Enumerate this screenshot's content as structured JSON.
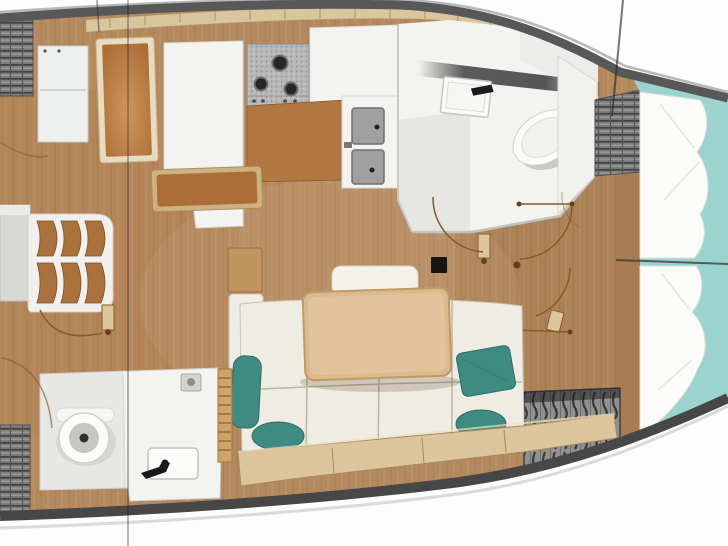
{
  "diagram": {
    "type": "yacht-interior-floorplan",
    "orientation": "bow-right",
    "regions": [
      {
        "name": "aft-lockers",
        "style": "hatched"
      },
      {
        "name": "companionway-steps",
        "steps": 3
      },
      {
        "name": "chart-table"
      },
      {
        "name": "galley",
        "fixtures": [
          "fridge",
          "stove-3-burner",
          "double-sink",
          "counter",
          "bench"
        ]
      },
      {
        "name": "forward-head",
        "fixtures": [
          "wash-basin",
          "faucet",
          "toilet",
          "door"
        ]
      },
      {
        "name": "aft-head",
        "fixtures": [
          "toilet",
          "wash-basin",
          "faucet",
          "shower-drain",
          "door"
        ]
      },
      {
        "name": "salon",
        "fixtures": [
          "l-settee",
          "dining-table",
          "headrest",
          "teal-pillows",
          "mast-post"
        ]
      },
      {
        "name": "forward-cabin",
        "fixtures": [
          "v-berth",
          "pillows",
          "hanging-locker",
          "shelf-locker",
          "door"
        ]
      }
    ]
  },
  "colors": {
    "outside": "#fdfdfd",
    "floor": "#b5895e",
    "hull_band_top": "#585858",
    "hull_band_bottom": "#474747",
    "deck_trim": "#d9c69c",
    "counter": "#f3f3f1",
    "cabinet_wood": "#aa6e36",
    "trim_tan": "#cdb183",
    "table_wood": "#ddba8c",
    "cushion": "#efece3",
    "cushion_base": "#dcc49c",
    "teal_pillow": "#3d8b81",
    "teal_mattress": "#9bd4cf",
    "hatch_gray": "#7d7d7d",
    "arc": "#8a5a28",
    "fixture_white": "#fbfbf9",
    "steel": "#a0a0a0"
  }
}
